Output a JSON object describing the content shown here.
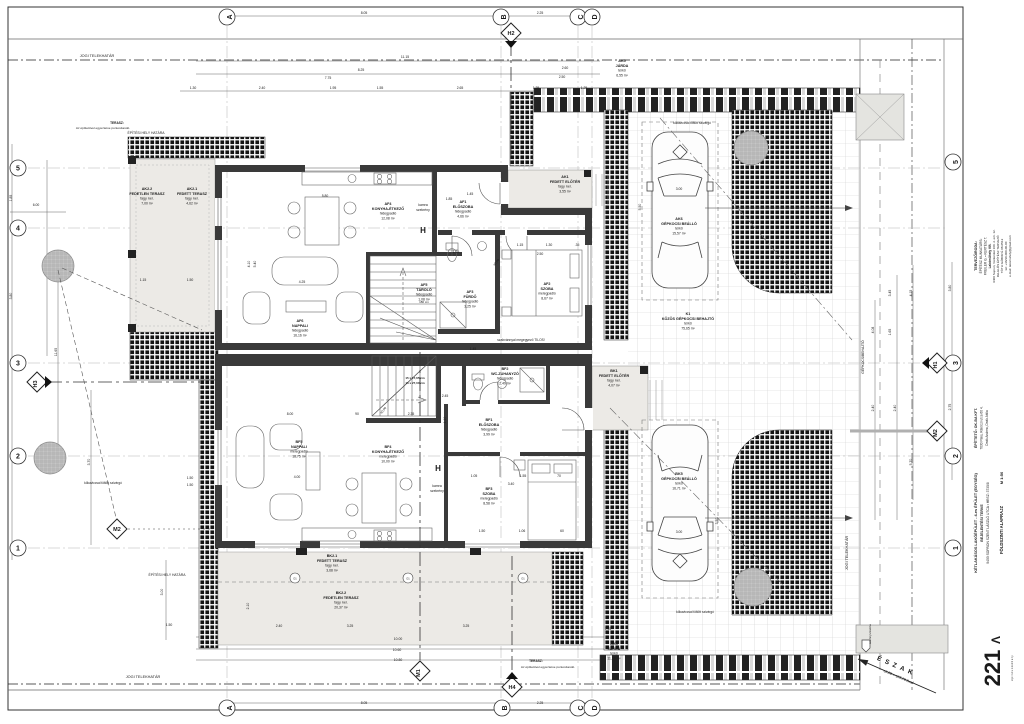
{
  "north": {
    "label": "ÉSZAK",
    "level": "±0,00 = 105,70 Bszf"
  },
  "rooms": [
    {
      "code": "AK2.2",
      "name": "FEDETLEN TERASZ",
      "floor": "fagy. ker.",
      "area": "7,00 m²",
      "x": 147,
      "y": 190
    },
    {
      "code": "AK2.1",
      "name": "FEDETT TERASZ",
      "floor": "fagy. ker.",
      "area": "4,62 m²",
      "x": 192,
      "y": 190
    },
    {
      "code": "AF4",
      "name": "KONYHA-ÉTKEZŐ",
      "floor": "hidegpadló",
      "area": "12,08 m²",
      "x": 388,
      "y": 205
    },
    {
      "code": "AF6",
      "name": "NAPPALI",
      "floor": "hidegpadló",
      "area": "16,16 m²",
      "x": 300,
      "y": 322
    },
    {
      "code": "AF5",
      "name": "TÁROLÓ",
      "floor": "hidegpadló",
      "area": "1,08 m²",
      "x": 424,
      "y": 286
    },
    {
      "code": "AF1",
      "name": "ELŐSZOBA",
      "floor": "hidegpadló",
      "area": "4,66 m²",
      "x": 463,
      "y": 203
    },
    {
      "code": "AK1",
      "name": "FEDETT ELŐTÉR",
      "floor": "fagy. ker.",
      "area": "3,55 m²",
      "x": 565,
      "y": 178
    },
    {
      "code": "AF2",
      "name": "SZOBA",
      "floor": "melegpadló",
      "area": "8,67 m²",
      "x": 547,
      "y": 285
    },
    {
      "code": "AF3",
      "name": "FÜRDŐ",
      "floor": "hidegpadló",
      "area": "3,25 m²",
      "x": 470,
      "y": 293
    },
    {
      "code": "BF5",
      "name": "NAPPALI",
      "floor": "melegpadló",
      "area": "18,75 m²",
      "x": 299,
      "y": 443
    },
    {
      "code": "BF4",
      "name": "KONYHA-ÉTKEZŐ",
      "floor": "melegpadló",
      "area": "10,00 m²",
      "x": 388,
      "y": 448
    },
    {
      "code": "BF2",
      "name": "WC-ZUHANYZÓ",
      "floor": "hidegpadló",
      "area": "2,49 m²",
      "x": 505,
      "y": 370
    },
    {
      "code": "BF1",
      "name": "ELŐSZOBA",
      "floor": "hidegpadló",
      "area": "3,99 m²",
      "x": 489,
      "y": 421
    },
    {
      "code": "BF3",
      "name": "SZOBA",
      "floor": "melegpadló",
      "area": "8,58 m²",
      "x": 489,
      "y": 490
    },
    {
      "code": "BK1",
      "name": "FEDETT ELŐTÉR",
      "floor": "fagy. ker.",
      "area": "4,07 m²",
      "x": 614,
      "y": 372
    },
    {
      "code": "BK2.1",
      "name": "FEDETT TERASZ",
      "floor": "fagy. ker.",
      "area": "3,68 m²",
      "x": 332,
      "y": 557
    },
    {
      "code": "BK2.2",
      "name": "FEDETLEN TERASZ",
      "floor": "fagy. ker.",
      "area": "20,37 m²",
      "x": 341,
      "y": 594
    },
    {
      "code": "AK6",
      "name": "GÉPKOCSI BEÁLLÓ",
      "floor": "térkő",
      "area": "15,57 m²",
      "x": 679,
      "y": 220
    },
    {
      "code": "K1",
      "name": "KÖZÖS GÉPKOCSI BEHAJTÓ",
      "floor": "térkő",
      "area": "75,65 m²",
      "x": 688,
      "y": 315
    },
    {
      "code": "BK5",
      "name": "GÉPKOCSI BEÁLLÓ",
      "floor": "térkő",
      "area": "16,71 m²",
      "x": 679,
      "y": 475
    },
    {
      "code": "AK5",
      "name": "JÁRDA",
      "floor": "térkő",
      "area": "6,55 m²",
      "x": 622,
      "y": 62
    },
    {
      "code": "BK4",
      "name": "JÁRDA",
      "floor": "térkő",
      "area": "11,10 m²",
      "x": 614,
      "y": 645
    }
  ],
  "site": {
    "boundary_labels": [
      {
        "text": "JOGI TELEKHATÁR",
        "x": 97,
        "y": 57
      },
      {
        "text": "JOGI TELEKHATÁR",
        "x": 143,
        "y": 678
      },
      {
        "text": "JOGI TELEKHATÁR",
        "x": 848,
        "y": 553,
        "r": -90
      },
      {
        "text": "ÉPÍTÉSI HELY HATÁRA",
        "x": 146,
        "y": 134,
        "s": 3.4
      },
      {
        "text": "ÉPÍTÉSI HELY HATÁRA",
        "x": 167,
        "y": 576,
        "s": 3.4
      },
      {
        "text": "GÉPKOCSIBEHAJTÓ",
        "x": 864,
        "y": 357,
        "r": -90,
        "s": 3.4
      }
    ],
    "notes": [
      {
        "text": "TERASZ:",
        "x": 117,
        "y": 124,
        "s": 3.2,
        "b": 1
      },
      {
        "text": "Az építtetővel egyeztetve pontosítandó.",
        "x": 103,
        "y": 129,
        "s": 3.1
      },
      {
        "text": "TERASZ:",
        "x": 536,
        "y": 662,
        "s": 3.2,
        "b": 1
      },
      {
        "text": "Az építtetővel egyeztetve pontosítandó.",
        "x": 548,
        "y": 668,
        "s": 3.1
      },
      {
        "text": "kőkaviccsal töltött szivárgó",
        "x": 103,
        "y": 484,
        "s": 3.2
      },
      {
        "text": "kőkaviccsal töltött szivárgó",
        "x": 692,
        "y": 124,
        "s": 3.2
      },
      {
        "text": "kőkaviccsal töltött szivárgó",
        "x": 695,
        "y": 613,
        "s": 3.2
      },
      {
        "text": "szabvánnyal megegyező TILOS!",
        "x": 521,
        "y": 341,
        "s": 3.3
      },
      {
        "text": "szennyvízakna",
        "x": 871,
        "y": 634,
        "s": 3,
        "r": -90
      }
    ]
  },
  "annotations": [
    {
      "t": "kamra",
      "x": 423,
      "y": 206,
      "s": 3.4
    },
    {
      "t": "szekrény",
      "x": 423,
      "y": 211,
      "s": 3.4
    },
    {
      "t": "H",
      "x": 423,
      "y": 233,
      "s": 8,
      "b": 1
    },
    {
      "t": "H",
      "x": 438,
      "y": 471,
      "s": 8,
      "b": 1
    },
    {
      "t": "kamra",
      "x": 437,
      "y": 487,
      "s": 3.4
    },
    {
      "t": "szekrény",
      "x": 437,
      "y": 492,
      "s": 3.4
    },
    {
      "t": "15 x 17,65 cm",
      "x": 415,
      "y": 379,
      "s": 3,
      "b": 1
    },
    {
      "t": "16 x 27,00 cm",
      "x": 415,
      "y": 384,
      "s": 3,
      "b": 1
    },
    {
      "t": "±0,00",
      "x": 497,
      "y": 263,
      "s": 3.2,
      "r": -50
    },
    {
      "t": "±0,00",
      "x": 384,
      "y": 411,
      "s": 3.2,
      "r": -50
    },
    {
      "t": "O1",
      "x": 295,
      "y": 579.5,
      "s": 2.6
    },
    {
      "t": "O1",
      "x": 408,
      "y": 579.5,
      "s": 2.6
    },
    {
      "t": "O1",
      "x": 523,
      "y": 579.5,
      "s": 2.6
    },
    {
      "t": "180 cm",
      "x": 424,
      "y": 303,
      "s": 3
    }
  ],
  "grid_axes": {
    "top": [
      {
        "label": "A",
        "x": 227
      },
      {
        "label": "B",
        "x": 501
      },
      {
        "label": "C",
        "x": 578
      },
      {
        "label": "D",
        "x": 592
      }
    ],
    "bottom": [
      {
        "label": "A",
        "x": 227
      },
      {
        "label": "B",
        "x": 502
      },
      {
        "label": "C",
        "x": 578
      },
      {
        "label": "D",
        "x": 592
      }
    ],
    "left": [
      {
        "label": "5",
        "y": 168
      },
      {
        "label": "4",
        "y": 228
      },
      {
        "label": "3",
        "y": 363
      },
      {
        "label": "2",
        "y": 456
      },
      {
        "label": "1",
        "y": 548
      }
    ],
    "right": [
      {
        "label": "5",
        "y": 162
      },
      {
        "label": "3",
        "y": 363
      },
      {
        "label": "2",
        "y": 456
      },
      {
        "label": "1",
        "y": 548
      }
    ]
  },
  "markers": [
    {
      "label": "H2",
      "x": 511,
      "y": 33,
      "type": "H",
      "tri": "bottom"
    },
    {
      "label": "H4",
      "x": 512,
      "y": 687,
      "type": "H",
      "tri": "top"
    },
    {
      "label": "H3",
      "x": 37,
      "y": 382,
      "type": "H",
      "tri": "right",
      "rot": -90
    },
    {
      "label": "H1",
      "x": 937,
      "y": 363,
      "type": "H",
      "tri": "left",
      "rot": -90
    },
    {
      "label": "M2",
      "x": 937,
      "y": 431,
      "type": "M",
      "rot": -90
    },
    {
      "label": "M2",
      "x": 117,
      "y": 529,
      "type": "M"
    },
    {
      "label": "M1",
      "x": 420,
      "y": 671,
      "type": "M",
      "rot": -90
    }
  ],
  "dimensions": [
    {
      "t": "8.05",
      "x": 364,
      "y": 14
    },
    {
      "t": "2.25",
      "x": 540,
      "y": 14
    },
    {
      "t": "11.15",
      "x": 405,
      "y": 58
    },
    {
      "t": "8.25",
      "x": 361,
      "y": 71
    },
    {
      "t": "2.60",
      "x": 565,
      "y": 69
    },
    {
      "t": "7.75",
      "x": 328,
      "y": 79
    },
    {
      "t": "2.50",
      "x": 562,
      "y": 78
    },
    {
      "t": "1.30",
      "x": 193,
      "y": 89
    },
    {
      "t": "2.40",
      "x": 262,
      "y": 89
    },
    {
      "t": "1.95",
      "x": 333,
      "y": 89
    },
    {
      "t": "1.55",
      "x": 380,
      "y": 89
    },
    {
      "t": "2.65",
      "x": 460,
      "y": 89
    },
    {
      "t": "1.35",
      "x": 536,
      "y": 89
    },
    {
      "t": "1.25",
      "x": 584,
      "y": 89
    },
    {
      "t": "5.80",
      "x": 325,
      "y": 197
    },
    {
      "t": "4.25",
      "x": 302,
      "y": 283
    },
    {
      "t": "4.10",
      "x": 250,
      "y": 264,
      "r": -90
    },
    {
      "t": "5.40",
      "x": 256,
      "y": 264,
      "r": -90
    },
    {
      "t": "1.15",
      "x": 143,
      "y": 281
    },
    {
      "t": "1.50",
      "x": 190,
      "y": 281
    },
    {
      "t": "1.45",
      "x": 470,
      "y": 195
    },
    {
      "t": "1.85",
      "x": 449,
      "y": 200
    },
    {
      "t": "1.25",
      "x": 456,
      "y": 253
    },
    {
      "t": "1.15",
      "x": 520,
      "y": 246
    },
    {
      "t": "1.30",
      "x": 549,
      "y": 246
    },
    {
      "t": "2.50",
      "x": 540,
      "y": 255
    },
    {
      "t": ".35",
      "x": 577,
      "y": 246
    },
    {
      "t": "1.45",
      "x": 473,
      "y": 350
    },
    {
      "t": "8.00",
      "x": 290,
      "y": 415
    },
    {
      "t": "90",
      "x": 357,
      "y": 415
    },
    {
      "t": "2.35",
      "x": 411,
      "y": 415
    },
    {
      "t": "2.45",
      "x": 445,
      "y": 397
    },
    {
      "t": "4.00",
      "x": 297,
      "y": 478
    },
    {
      "t": "3.40",
      "x": 511,
      "y": 485
    },
    {
      "t": "1.55",
      "x": 523,
      "y": 477
    },
    {
      "t": "70",
      "x": 559,
      "y": 477
    },
    {
      "t": "1.05",
      "x": 474,
      "y": 477
    },
    {
      "t": "1.50",
      "x": 482,
      "y": 532
    },
    {
      "t": "1.06",
      "x": 522,
      "y": 532
    },
    {
      "t": "60",
      "x": 562,
      "y": 532
    },
    {
      "t": "1.10",
      "x": 446,
      "y": 420,
      "r": -90
    },
    {
      "t": "2.40",
      "x": 279,
      "y": 627
    },
    {
      "t": "3.25",
      "x": 350,
      "y": 627
    },
    {
      "t": "3.25",
      "x": 466,
      "y": 627
    },
    {
      "t": "10.00",
      "x": 398,
      "y": 640
    },
    {
      "t": "10.60",
      "x": 397,
      "y": 651
    },
    {
      "t": "10.80",
      "x": 398,
      "y": 661
    },
    {
      "t": "8.05",
      "x": 364,
      "y": 704
    },
    {
      "t": "2.25",
      "x": 540,
      "y": 704
    },
    {
      "t": "2.10",
      "x": 249,
      "y": 606,
      "r": -90
    },
    {
      "t": "1.85",
      "x": 12,
      "y": 198,
      "r": -90
    },
    {
      "t": "3.80",
      "x": 12,
      "y": 296,
      "r": -90
    },
    {
      "t": "6.00",
      "x": 36,
      "y": 206
    },
    {
      "t": "11.65",
      "x": 57,
      "y": 352,
      "r": -90
    },
    {
      "t": "3.70",
      "x": 90,
      "y": 462,
      "r": -90
    },
    {
      "t": "3.00",
      "x": 163,
      "y": 592,
      "r": -90
    },
    {
      "t": "1.50",
      "x": 169,
      "y": 626
    },
    {
      "t": "1.50",
      "x": 190,
      "y": 479
    },
    {
      "t": "1.50",
      "x": 190,
      "y": 486
    },
    {
      "t": "3.45",
      "x": 891,
      "y": 293,
      "r": -90
    },
    {
      "t": "4.15",
      "x": 912,
      "y": 293,
      "r": -90
    },
    {
      "t": "3.80",
      "x": 951,
      "y": 288,
      "r": -90
    },
    {
      "t": "1.65",
      "x": 891,
      "y": 332,
      "r": -90
    },
    {
      "t": "4.08",
      "x": 874,
      "y": 330,
      "r": -90
    },
    {
      "t": "2.40",
      "x": 874,
      "y": 408,
      "r": -90
    },
    {
      "t": "2.40",
      "x": 896,
      "y": 408,
      "r": -90
    },
    {
      "t": "2.75",
      "x": 951,
      "y": 407,
      "r": -90
    },
    {
      "t": "5.70",
      "x": 912,
      "y": 462,
      "r": -90
    },
    {
      "t": "3.00",
      "x": 679,
      "y": 190
    },
    {
      "t": "3.00",
      "x": 679,
      "y": 533
    },
    {
      "t": "5.50",
      "x": 641,
      "y": 207,
      "r": -90
    },
    {
      "t": "3.50",
      "x": 718,
      "y": 521,
      "r": -90
    },
    {
      "t": "1.15",
      "x": 608,
      "y": 630
    }
  ],
  "title_block": {
    "texts": [
      {
        "t": "TERVEZŐIRODA:",
        "x": 977,
        "y": 256,
        "s": 3.6,
        "b": 1,
        "r": -90
      },
      {
        "t": "ÉPÍTÉSZ MUNKATÁRS:",
        "x": 982,
        "y": 256,
        "s": 3.2,
        "r": -90
      },
      {
        "t": "FREILER G. • KERTÉSZ T.",
        "x": 986.5,
        "y": 256,
        "s": 3.2,
        "r": -90
      },
      {
        "t": "Lakóműhely Kft.",
        "x": 991,
        "y": 256,
        "s": 3.2,
        "b": 1,
        "r": -90
      },
      {
        "t": "9400 Sopron, Várkerület 100. 2. em. 12.",
        "x": 995,
        "y": 256,
        "s": 3,
        "r": -90
      },
      {
        "t": "FELELŐS ÉPÍTÉSZ TERVEZŐ:",
        "x": 999,
        "y": 256,
        "s": 3,
        "r": -90
      },
      {
        "t": "TÓTH GÁBOR  É 08-0512",
        "x": 1003,
        "y": 256,
        "s": 3,
        "r": -90
      },
      {
        "t": "tel: +36/30-000-00-00",
        "x": 1007,
        "y": 256,
        "s": 3,
        "r": -90
      },
      {
        "t": "e-mail: lakomuhely@gmail.com",
        "x": 1011,
        "y": 256,
        "s": 3,
        "r": -90
      },
      {
        "t": "ÉPÍTTETŐ:  OK-BA KFT.",
        "x": 977,
        "y": 428,
        "s": 3.6,
        "b": 1,
        "r": -90
      },
      {
        "t": "7030 Paks, Rákóczi utca 60 4.",
        "x": 982.5,
        "y": 428,
        "s": 3.2,
        "r": -90
      },
      {
        "t": "Deák Andrea, Deák Attila",
        "x": 988,
        "y": 428,
        "s": 3.2,
        "r": -90
      },
      {
        "t": "KÉTLAKÁSOS LAKÓÉPÜLET - 4-es ÉPÜLET (EGYSÉG)",
        "x": 977,
        "y": 523,
        "s": 3.8,
        "b": 1,
        "r": -90
      },
      {
        "t": "BEJELENTÉSI TERVE",
        "x": 983,
        "y": 523,
        "s": 3.6,
        "b": 1,
        "r": -90
      },
      {
        "t": "9400 SOPRON SZENT LÁSZLÓ UTCA • HRSZ: 3735/8",
        "x": 989,
        "y": 523,
        "s": 3.3,
        "r": -90
      },
      {
        "t": "M 1:50",
        "x": 1003,
        "y": 478,
        "s": 4,
        "b": 1,
        "r": -90
      },
      {
        "t": "FÖLDSZINTI ALAPRAJZ",
        "x": 1003,
        "y": 530,
        "s": 4.2,
        "b": 1,
        "r": -90
      },
      {
        "t": "Λ",
        "x": 1000,
        "y": 640,
        "s": 12,
        "b": 1,
        "r": -90
      },
      {
        "t": "221",
        "x": 1000,
        "y": 668,
        "s": 22,
        "b": 1,
        "r": -90
      },
      {
        "t": "é p í t é s z   m ű h e l y",
        "x": 1013,
        "y": 668,
        "s": 2.6,
        "r": -90
      }
    ]
  }
}
